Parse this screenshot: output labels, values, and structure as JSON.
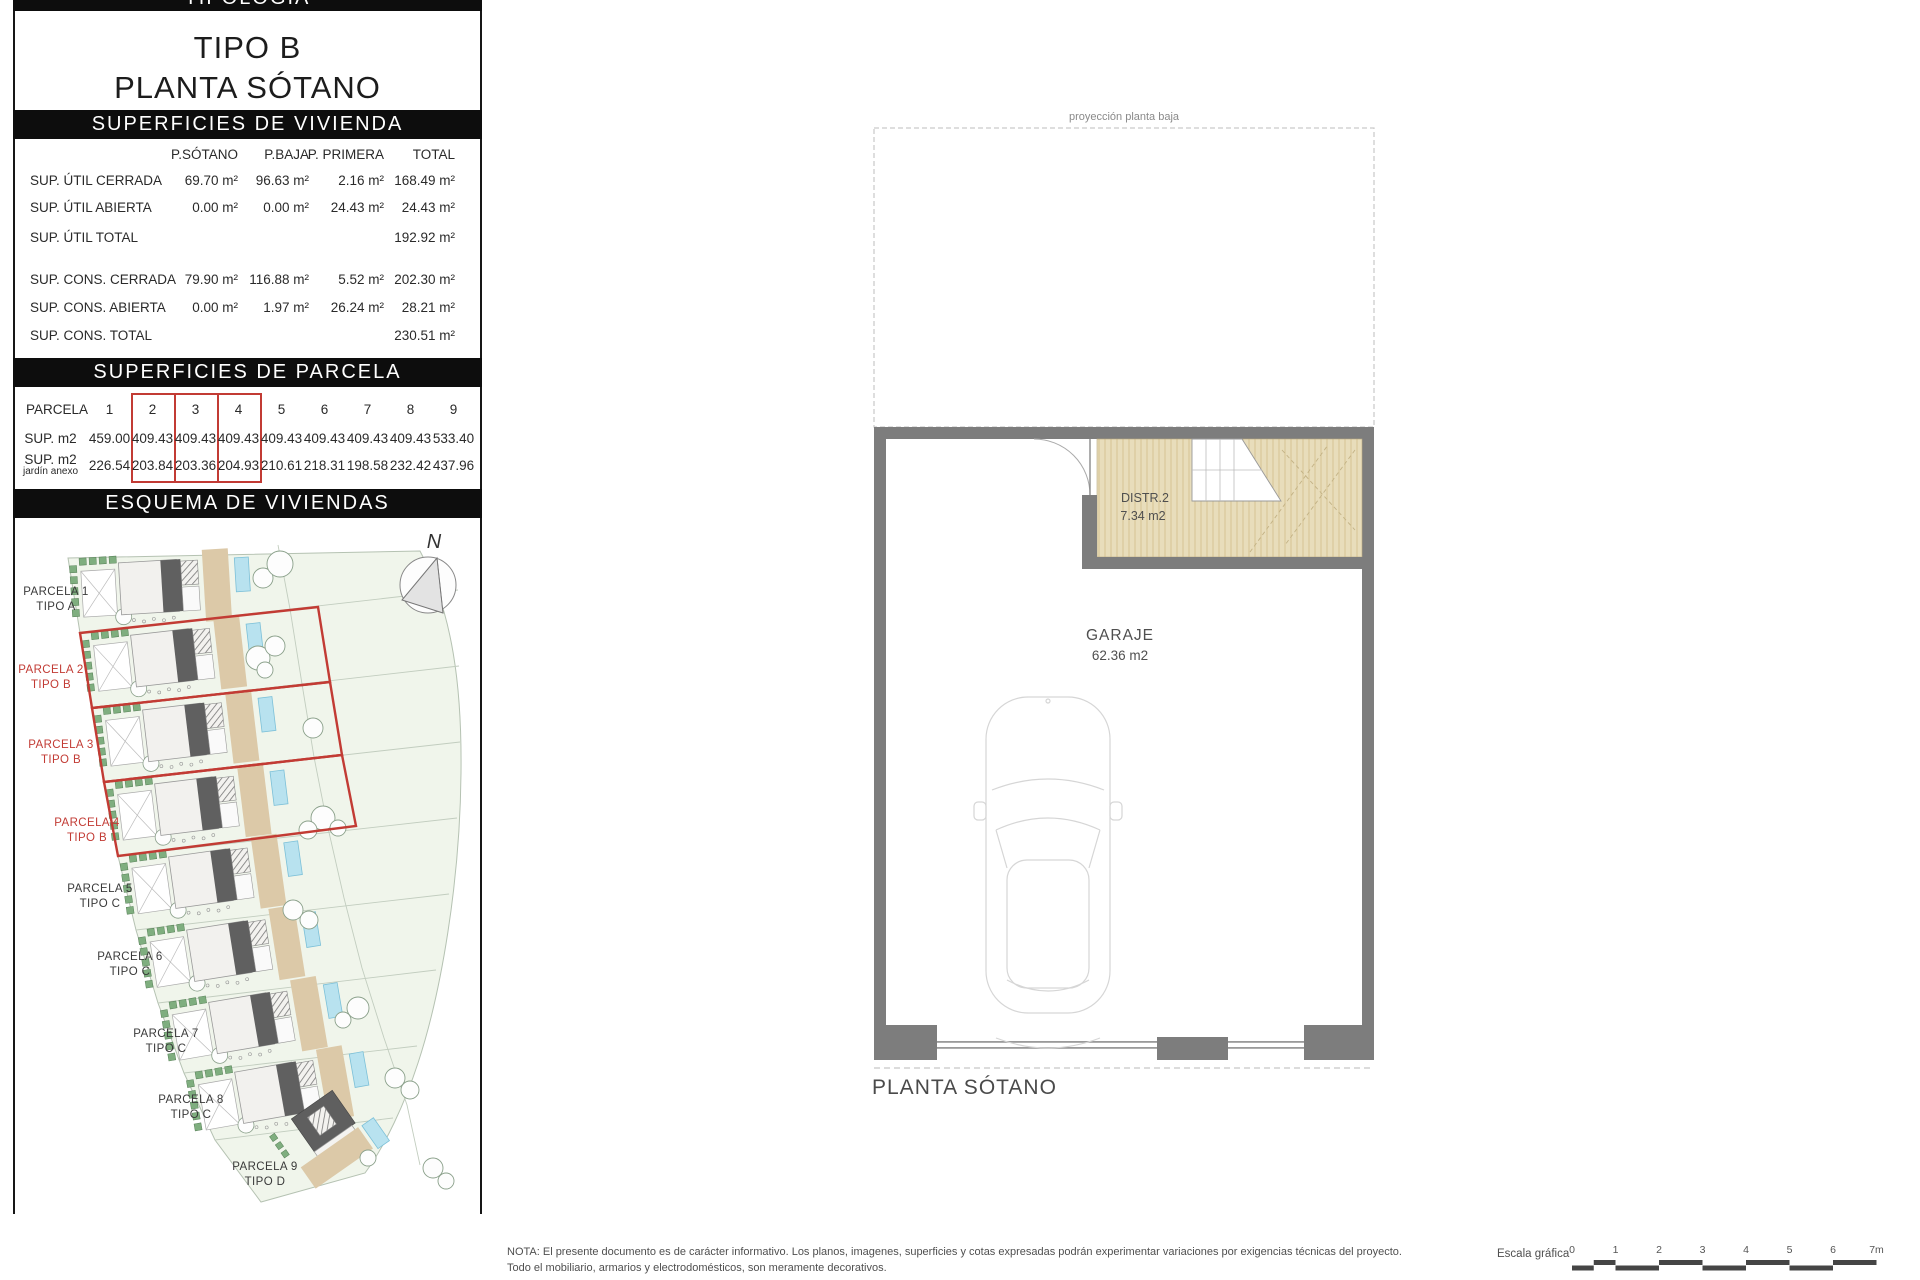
{
  "panel": {
    "tipologia": "TIPOLOGIA",
    "tipo": "TIPO B",
    "planta": "PLANTA SÓTANO",
    "vivienda": {
      "title": "SUPERFICIES DE VIVIENDA",
      "columns": [
        "P.SÓTANO",
        "P.BAJA",
        "P. PRIMERA",
        "TOTAL"
      ],
      "rows": [
        {
          "label": "SUP. ÚTIL CERRADA",
          "values": [
            "69.70 m²",
            "96.63 m²",
            "2.16 m²",
            "168.49 m²"
          ]
        },
        {
          "label": "SUP. ÚTIL ABIERTA",
          "values": [
            "0.00 m²",
            "0.00 m²",
            "24.43 m²",
            "24.43 m²"
          ]
        },
        {
          "label": "SUP. ÚTIL TOTAL",
          "values": [
            "",
            "",
            "",
            "192.92 m²"
          ]
        },
        {
          "label": "SUP. CONS. CERRADA",
          "values": [
            "79.90 m²",
            "116.88 m²",
            "5.52 m²",
            "202.30 m²"
          ]
        },
        {
          "label": "SUP. CONS. ABIERTA",
          "values": [
            "0.00 m²",
            "1.97 m²",
            "26.24 m²",
            "28.21 m²"
          ]
        },
        {
          "label": "SUP. CONS. TOTAL",
          "values": [
            "",
            "",
            "",
            "230.51 m²"
          ]
        }
      ]
    },
    "parcela": {
      "title": "SUPERFICIES DE PARCELA",
      "row_header": "PARCELA",
      "sup_label": "SUP. m2",
      "jardin_label": "SUP. m2",
      "jardin_sublabel": "jardín anexo",
      "ids": [
        "1",
        "2",
        "3",
        "4",
        "5",
        "6",
        "7",
        "8",
        "9"
      ],
      "sup": [
        "459.00",
        "409.43",
        "409.43",
        "409.43",
        "409.43",
        "409.43",
        "409.43",
        "409.43",
        "533.40"
      ],
      "jardin": [
        "226.54",
        "203.84",
        "203.36",
        "204.93",
        "210.61",
        "218.31",
        "198.58",
        "232.42",
        "437.96"
      ],
      "highlighted_ids": [
        "2",
        "3",
        "4"
      ]
    },
    "esquema_title": "ESQUEMA DE VIVIENDAS",
    "compass_letter": "N",
    "parcels": [
      {
        "name": "PARCELA 1",
        "tipo": "TIPO A",
        "highlight": false
      },
      {
        "name": "PARCELA 2",
        "tipo": "TIPO B",
        "highlight": true
      },
      {
        "name": "PARCELA 3",
        "tipo": "TIPO B",
        "highlight": true
      },
      {
        "name": "PARCELA 4",
        "tipo": "TIPO B",
        "highlight": true
      },
      {
        "name": "PARCELA 5",
        "tipo": "TIPO C",
        "highlight": false
      },
      {
        "name": "PARCELA 6",
        "tipo": "TIPO C",
        "highlight": false
      },
      {
        "name": "PARCELA 7",
        "tipo": "TIPO C",
        "highlight": false
      },
      {
        "name": "PARCELA 8",
        "tipo": "TIPO C",
        "highlight": false
      },
      {
        "name": "PARCELA 9",
        "tipo": "TIPO D",
        "highlight": false
      }
    ]
  },
  "plan": {
    "projection_label": "proyección planta baja",
    "distr_name": "DISTR.2",
    "distr_area": "7.34 m2",
    "garaje_name": "GARAJE",
    "garaje_area": "62.36 m2",
    "caption": "PLANTA SÓTANO"
  },
  "footer": {
    "note_line1": "NOTA: El presente documento es de carácter informativo. Los planos, imagenes, superficies y cotas expresadas podrán experimentar variaciones por exigencias técnicas del proyecto.",
    "note_line2": "Todo el mobiliario, armarios y electrodomésticos, son meramente decorativos.",
    "scale_label": "Escala gráfica",
    "scale_ticks": [
      "0",
      "1",
      "2",
      "3",
      "4",
      "5",
      "6",
      "7m"
    ]
  },
  "colors": {
    "header_bg": "#0d0d0d",
    "highlight_red": "#c23b34",
    "wall_gray": "#7d7d7d",
    "wood_tan": "#e8ddbb",
    "pool_blue": "#b8e2ef",
    "site_green": "#f0f5eb"
  }
}
